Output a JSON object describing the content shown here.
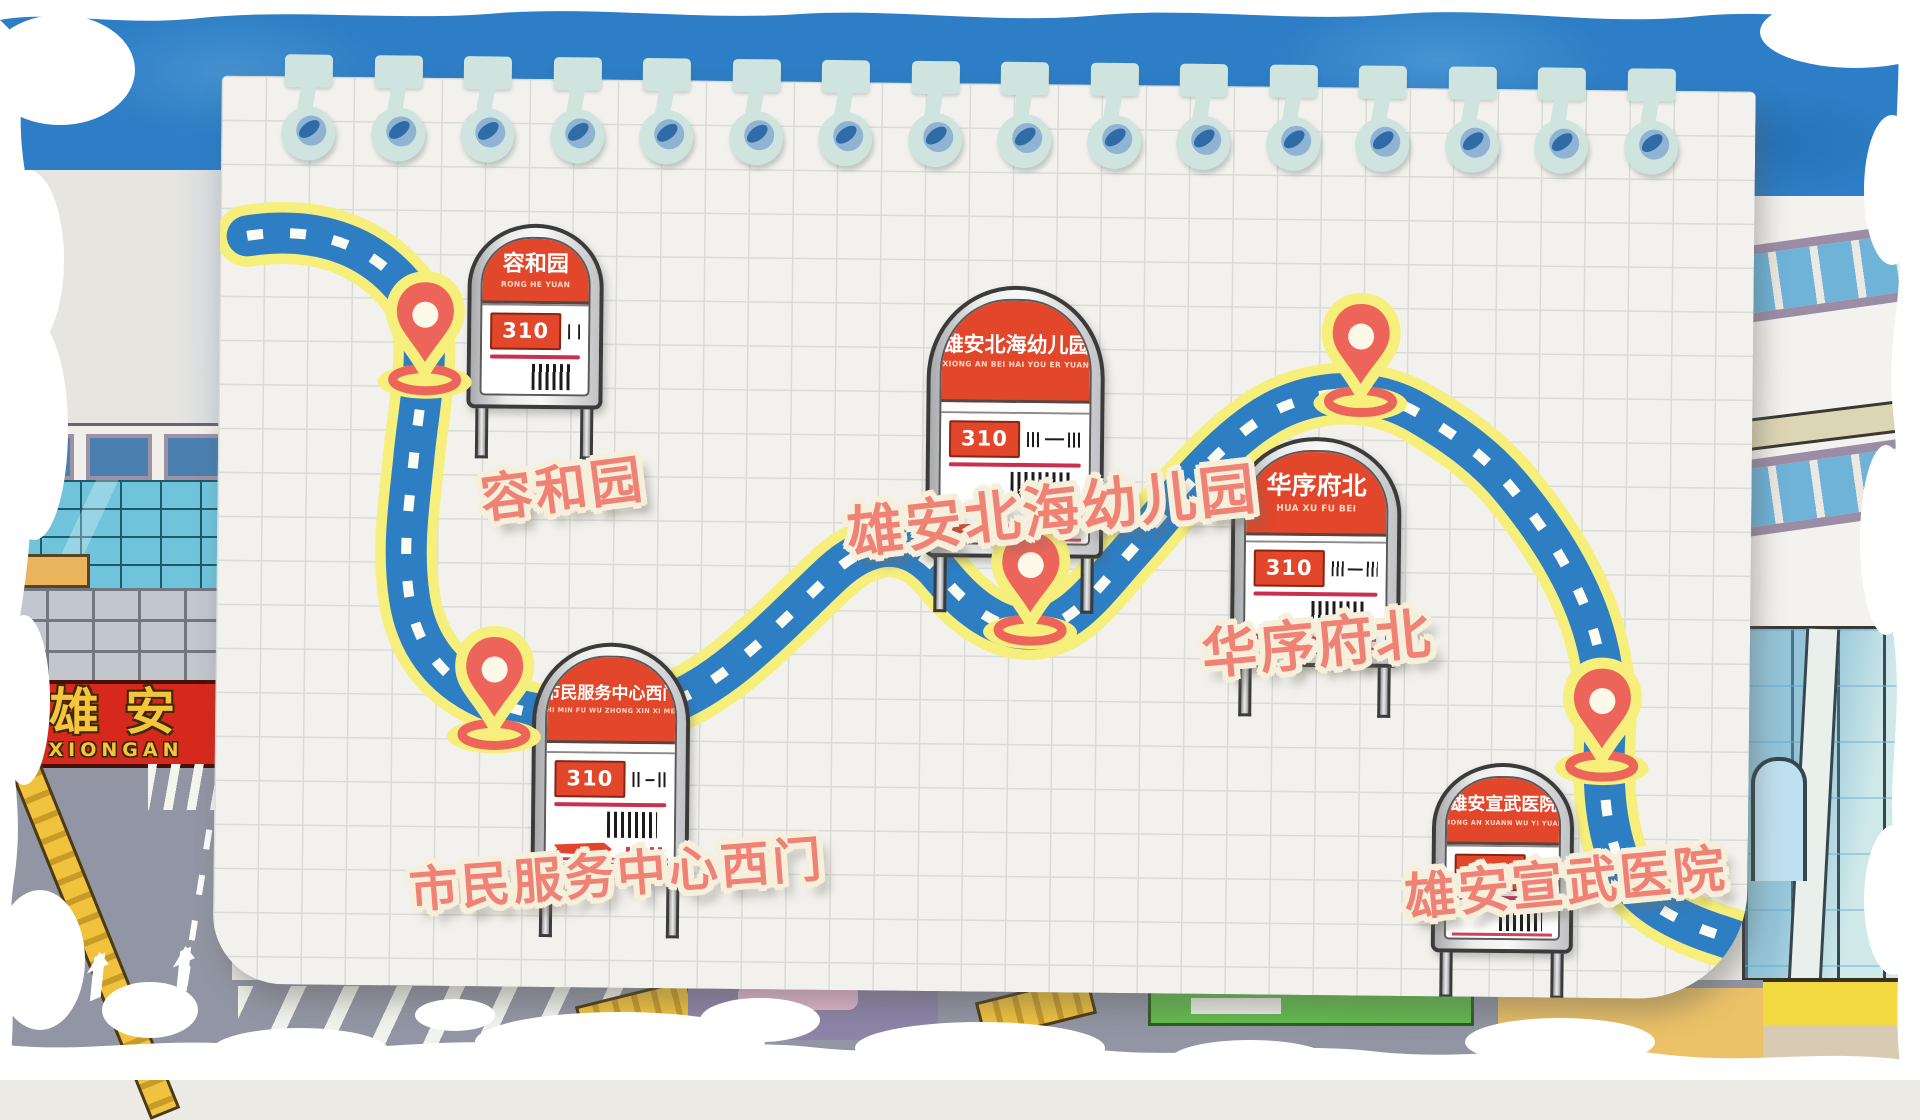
{
  "scene": {
    "type": "illustrated-bus-route-map",
    "region_label": {
      "title": "雄安",
      "subtitle": "XIONGAN"
    }
  },
  "route": {
    "number": "310",
    "stop_count": 5
  },
  "stops": [
    {
      "name": "容和园",
      "pinyin": "RONG HE YUAN",
      "route": "310"
    },
    {
      "name": "市民服务中心西门",
      "pinyin": "SHI MIN FU WU ZHONG XIN XI MEN",
      "route": "310"
    },
    {
      "name": "雄安北海幼儿园",
      "pinyin": "XIONG AN BEI HAI YOU ER YUAN",
      "route": "310"
    },
    {
      "name": "华序府北",
      "pinyin": "HUA XU FU BEI",
      "route": "310"
    },
    {
      "name": "雄安宣武医院",
      "pinyin": "XIONG AN XUANN WU YI YUAN",
      "route": "310"
    }
  ],
  "colors": {
    "road_blue": "#2e7ec4",
    "road_border_yellow": "#f6ef7b",
    "road_dash_white": "#fcfcf2",
    "pin_red": "#ed655a",
    "sign_red": "#e2472b",
    "label_coral": "#ef8175",
    "paper": "#f2f1ed",
    "sky_blue": "#2d7ec6",
    "region_sign_red": "#d6281c",
    "region_sign_gold": "#f6c43d"
  },
  "binding": {
    "ring_count": 16
  }
}
